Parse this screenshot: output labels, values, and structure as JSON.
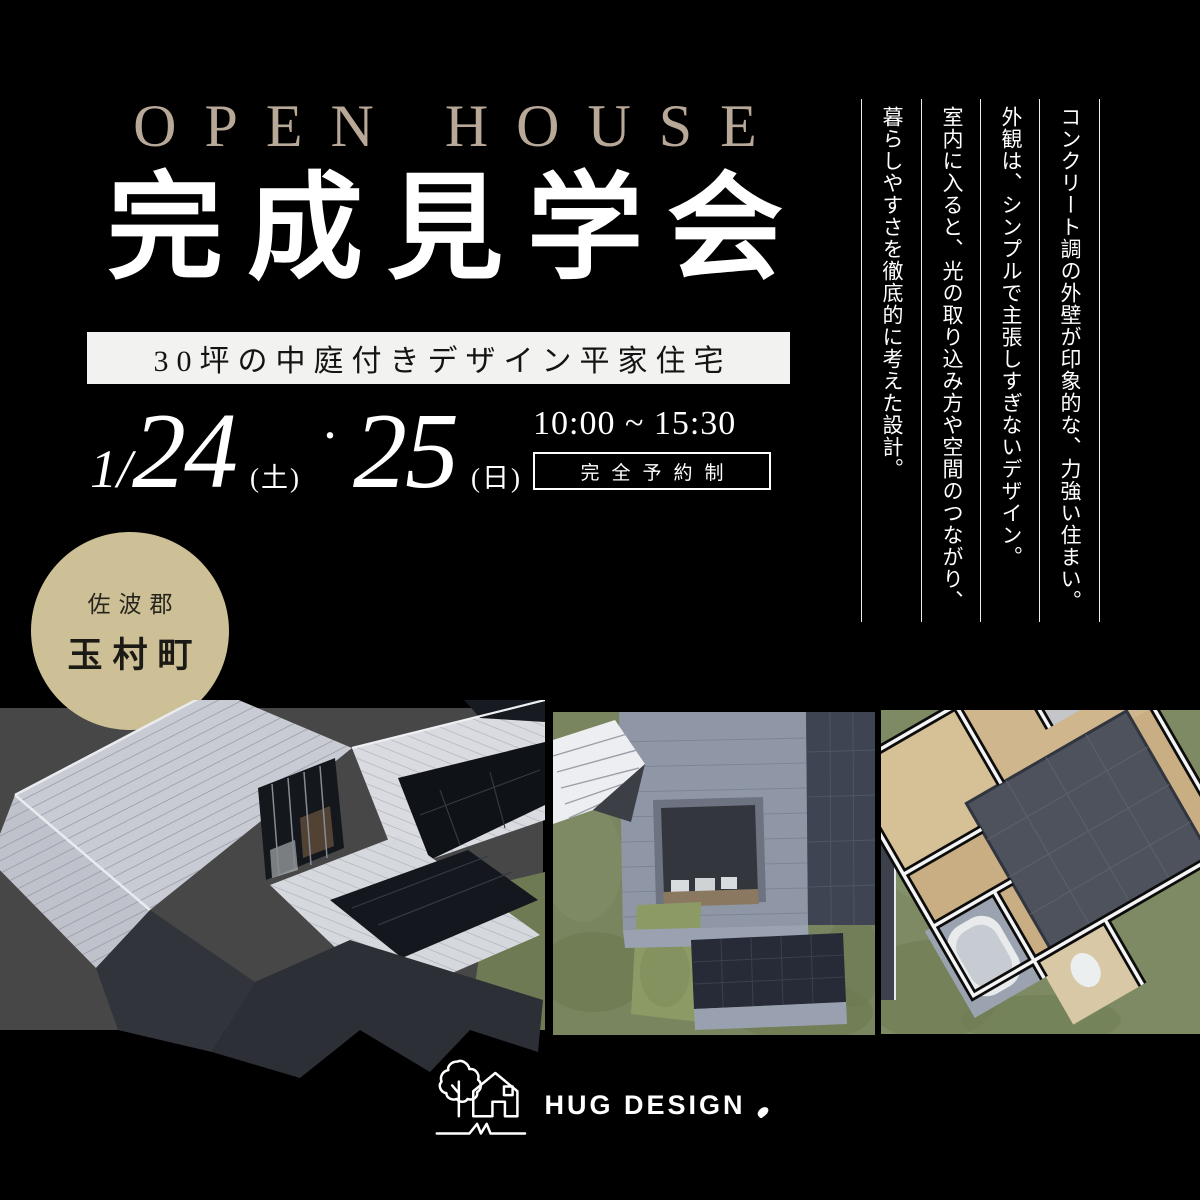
{
  "header": {
    "title_en": "OPEN HOUSE",
    "title_jp": "完成見学会",
    "subtitle": "30坪の中庭付きデザイン平家住宅"
  },
  "schedule": {
    "month": "1/",
    "day1": "24",
    "day1_dow": "(土)",
    "dot": "・",
    "day2": "25",
    "day2_dow": "(日)",
    "time": "10:00 ~ 15:30",
    "reservation": "完全予約制"
  },
  "description_columns": [
    "コンクリート調の外壁が印象的な、力強い住まい。",
    "外観は、シンプルで主張しすぎないデザイン。",
    "室内に入ると、光の取り込み方や空間のつながり、",
    "暮らしやすさを徹底的に考えた設計。"
  ],
  "location_badge": {
    "district": "佐波郡",
    "town": "玉村町"
  },
  "logo": {
    "brand": "HUG DESIGN"
  },
  "palette": {
    "background": "#000000",
    "accent_beige": "#b7a897",
    "badge_tan": "#cdc096",
    "band_white": "#f2f2f0",
    "photo_backdrop_gray": "#474747",
    "grass_green": "#79855e",
    "roof_light_gray": "#c8cbd3",
    "wall_charcoal": "#31343b",
    "wood_floor_tan": "#c9ae83"
  }
}
